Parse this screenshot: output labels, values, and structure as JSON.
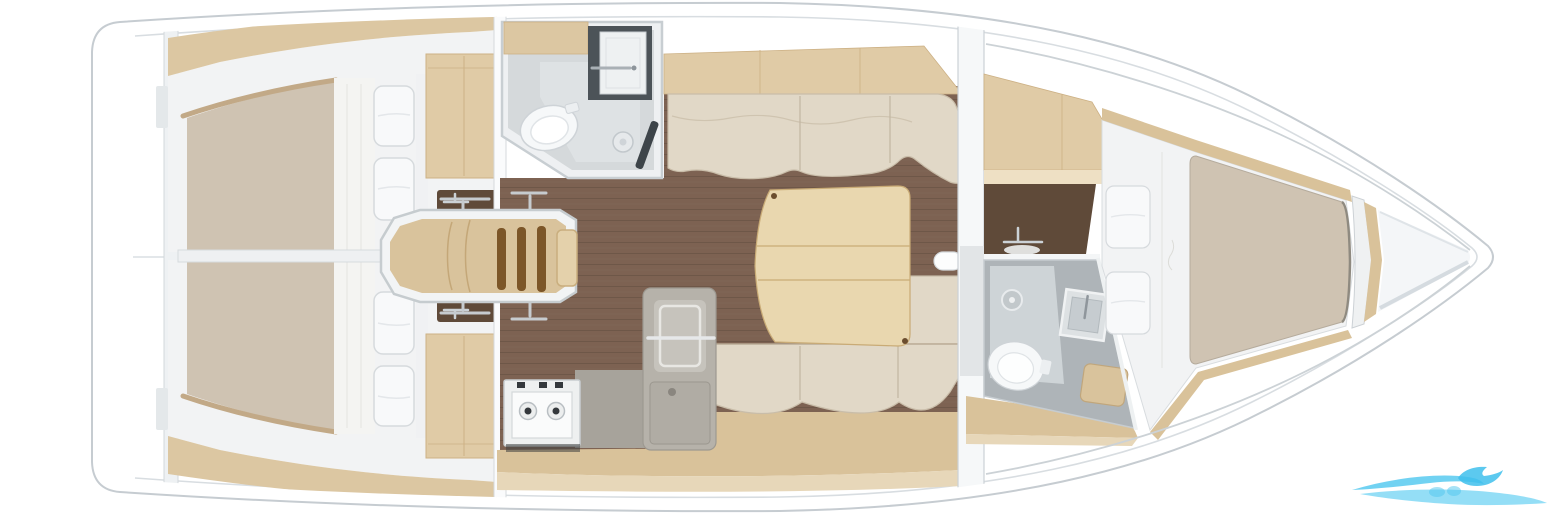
{
  "meta": {
    "description": "Top-down interior layout plan of a sailing yacht, bow pointing right",
    "width": 1560,
    "height": 519
  },
  "rooms": {
    "aft_cabin_port": "aft double cabin port",
    "aft_cabin_starboard": "aft double cabin starboard",
    "aft_head": "aft head with toilet sink and shower",
    "companionway": "companionway steps",
    "saloon": "saloon with settees and table",
    "galley": "galley with stove and sink unit",
    "forward_head": "forward head with shower toilet and sink",
    "forward_cabin": "forward v-berth cabin",
    "bow_locker": "bow anchor locker"
  },
  "palette": {
    "deck_white": "#ffffff",
    "hull_line": "#c6ccd1",
    "liner_white": "#f2f3f4",
    "wood": "#dcc7a2",
    "wood_mid": "#e0cba6",
    "wood_light": "#eee0c4",
    "wood_seam": "#cdb185",
    "floor_brown": "#7d6252",
    "mattress": "#cfc3b2",
    "linen": "#f8f9fa",
    "cushion": "#e1d8c7",
    "cushion_seam": "#c2b6a2",
    "table_wood": "#e9d7af",
    "table_edge": "#c9ab76",
    "step_wood": "#d9c39c",
    "step_slot": "#7c5628",
    "counter_dark": "#4c5358",
    "vanity_brown": "#5f4a39",
    "bath_wall": "#eef0f2",
    "bath_floor": "#d5d9db",
    "galley_gray": "#b6b2aa",
    "galley_panel": "#c6c3bc",
    "counter_gray": "#a7a39b",
    "stove_white": "#eef0f0",
    "knob_dark": "#34383c",
    "head_wall": "#aeb4b8",
    "head_floor": "#ced4d7",
    "sole": "#d9c29a",
    "sole_light": "#e7d7b9",
    "bow_deck": "#f4f6f8",
    "fixture_white": "#f6f8f9",
    "watermark_main": "#62cdf1",
    "watermark_deep": "#3fc0ec",
    "watermark_light": "#8edcf5"
  },
  "watermark": {
    "shape": "wave swoosh logo",
    "position": "bottom right"
  }
}
